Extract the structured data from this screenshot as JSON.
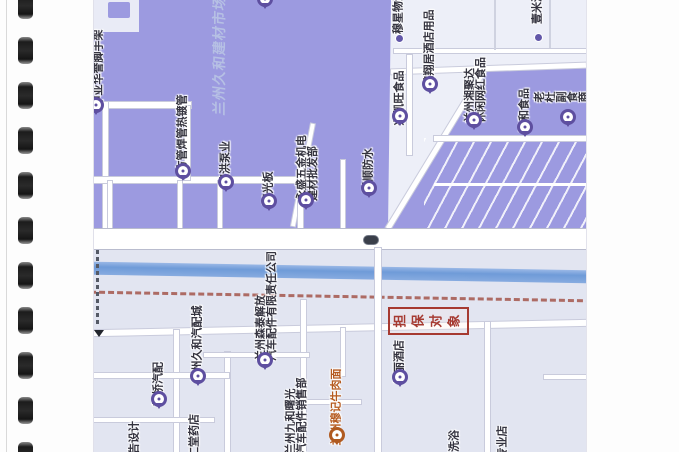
{
  "document": {
    "kind": "scanned spiral-bound page containing a printed map (rotated 90°)",
    "binding_holes": 11
  },
  "map": {
    "watermark": "兰州久和建材市场",
    "highlight": {
      "text": "担保对象",
      "box_color": "#a63a31"
    },
    "colors": {
      "industrial_zone": "#9c9ae0",
      "light_zone": "#edeff8",
      "lower_zone": "#e2e5f1",
      "river": "#6f9bd8",
      "boundary_dash": "#a4564c",
      "pin": "#5e4fa0",
      "pin_orange": "#b05a20",
      "label_text": "#34333f"
    },
    "icons": [
      {
        "name": "road-number-badge"
      },
      {
        "name": "direction-arrow"
      },
      {
        "name": "location-pin"
      },
      {
        "name": "poi-dot"
      }
    ],
    "markers": [
      {
        "name": "poi-zhongya-huayu",
        "type": "pin",
        "px": 2,
        "py": 116,
        "lx": 4,
        "ly": 68,
        "lines": "中亚华誉脚手架"
      },
      {
        "name": "poi-fangguan-hanguan",
        "type": "pin",
        "px": 89,
        "py": 182,
        "lx": 88,
        "ly": 133,
        "lines": "方管焊管热镀管"
      },
      {
        "name": "poi-jinhong-pump",
        "type": "pin",
        "px": 132,
        "py": 193,
        "lx": 131,
        "ly": 163,
        "lines": "锦洪泵业"
      },
      {
        "name": "poi-yangguangban",
        "type": "pin",
        "px": 175,
        "py": 212,
        "lx": 174,
        "ly": 188,
        "lines": "阳光板"
      },
      {
        "name": "poi-yongsheng-wujin",
        "type": "pin",
        "px": 212,
        "py": 211,
        "lx": 213,
        "ly": 168,
        "lines": "永盛五金机电\n建材批发部"
      },
      {
        "name": "poi-keshun-fangshui",
        "type": "pin",
        "px": 275,
        "py": 199,
        "lx": 274,
        "ly": 170,
        "lines": "科顺防水"
      },
      {
        "name": "poi-xingkaiwang-food",
        "type": "pin",
        "px": 306,
        "py": 127,
        "lx": 305,
        "ly": 98,
        "lines": "兴凯旺食品"
      },
      {
        "name": "poi-hongxiangju-hotel",
        "type": "pin",
        "px": 336,
        "py": 95,
        "lx": 335,
        "ly": 48,
        "lines": "鸿翔居酒店用品"
      },
      {
        "name": "poi-lanzhou-xiangjuda",
        "type": "pin",
        "px": 380,
        "py": 131,
        "lx": 381,
        "ly": 90,
        "lines": "兰州湘聚达\n休闲网红食品"
      },
      {
        "name": "poi-tianhe-food",
        "type": "pin",
        "px": 431,
        "py": 138,
        "lx": 430,
        "ly": 110,
        "lines": "天和食品"
      },
      {
        "name": "poi-laodu-fushi",
        "type": "pin",
        "px": 474,
        "py": 128,
        "lx": 473,
        "ly": 93,
        "lines": "老杜副食商行"
      },
      {
        "name": "poi-cut-top",
        "type": "pin",
        "px": 171,
        "py": 10,
        "lx": -40,
        "ly": -40,
        "lines": ""
      },
      {
        "name": "poi-muxing-wuliu",
        "type": "dot",
        "px": 305,
        "py": 38,
        "lx": 304,
        "ly": 12,
        "lines": "穆星物流"
      },
      {
        "name": "poi-yimidida",
        "type": "dot",
        "px": 444,
        "py": 37,
        "lx": 443,
        "ly": 2,
        "lines": "壹米滴答"
      },
      {
        "name": "poi-meili-hotel",
        "type": "pin",
        "px": 306,
        "py": 388,
        "lx": 305,
        "ly": 362,
        "lines": "美丽酒店"
      },
      {
        "name": "poi-xinqiao-qipei",
        "type": "pin",
        "px": 65,
        "py": 410,
        "lx": 64,
        "ly": 384,
        "lines": "新桥汽配"
      },
      {
        "name": "poi-jiuhe-qipeicheng",
        "type": "pin",
        "px": 104,
        "py": 387,
        "lx": 103,
        "ly": 344,
        "lines": "兰州久和汽配城"
      },
      {
        "name": "poi-sentai-jiefang",
        "type": "pin",
        "px": 171,
        "py": 371,
        "lx": 172,
        "ly": 306,
        "lines": "兰州森泰解放\n汽车配件有限责任公司"
      },
      {
        "name": "poi-jiuhe-shuguang",
        "type": "none",
        "px": 0,
        "py": 0,
        "lx": 202,
        "ly": 416,
        "lines": "兰州九和曙光\n汽车配件销售部"
      },
      {
        "name": "poi-niuroumian",
        "type": "pin-orange",
        "px": 243,
        "py": 446,
        "lx": 242,
        "ly": 407,
        "lines": "兰州穆记牛肉面",
        "color": "orange"
      },
      {
        "name": "poi-tang-yaodian",
        "type": "none",
        "px": 0,
        "py": 0,
        "lx": 100,
        "ly": 436,
        "lines": "仁堂药店"
      },
      {
        "name": "poi-guanggao-sheji",
        "type": "none",
        "px": 0,
        "py": 0,
        "lx": 40,
        "ly": 443,
        "lines": "广告设计"
      },
      {
        "name": "poi-xiyu",
        "type": "none",
        "px": 0,
        "py": 0,
        "lx": 360,
        "ly": 441,
        "lines": "洗浴"
      },
      {
        "name": "poi-zhuanyedian",
        "type": "none",
        "px": 0,
        "py": 0,
        "lx": 408,
        "ly": 442,
        "lines": "专业店"
      }
    ]
  }
}
